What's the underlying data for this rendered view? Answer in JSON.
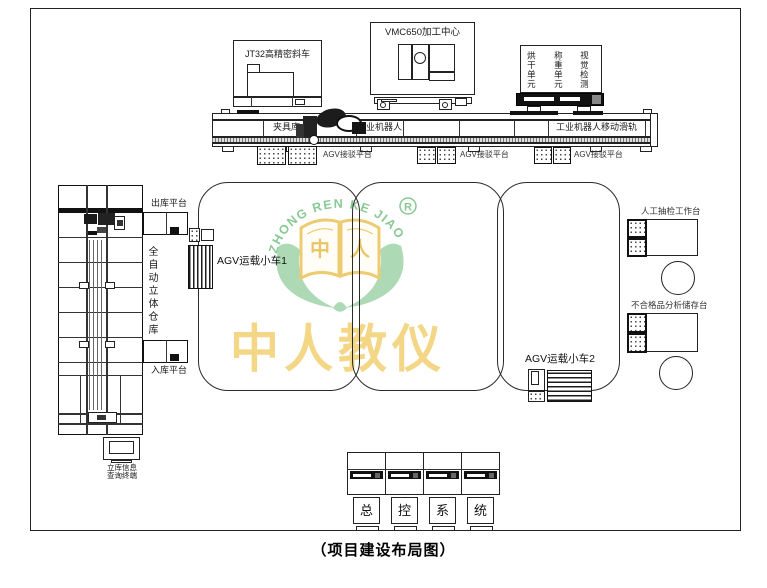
{
  "caption": "（项目建设布局图）",
  "machines": {
    "lathe_label": "JT32高精密斜车",
    "vmc_label": "VMC650加工中心",
    "unit_labels": [
      "烘干单元",
      "称重单元",
      "视觉检测"
    ]
  },
  "rail": {
    "fixture_store": "夹具库",
    "robot": "工业机器人",
    "robot_rail": "工业机器人移动滑轨",
    "agv_dock": "AGV接驳平台"
  },
  "warehouse": {
    "name_vertical": "全自动立体仓库",
    "outbound": "出库平台",
    "inbound": "入库平台",
    "terminal_line1": "立库信息",
    "terminal_line2": "查询终端"
  },
  "agv": {
    "cart1": "AGV运载小车1",
    "cart2": "AGV运载小车2"
  },
  "stations": {
    "manual_check": "人工抽检工作台",
    "defect_storage": "不合格品分析储存台"
  },
  "console": {
    "chars": [
      "总",
      "控",
      "系",
      "统"
    ]
  },
  "logo": {
    "arc_text": "ZHONG REN KE JIAO",
    "registered": "R",
    "book_left": "中",
    "book_right": "人",
    "watermark_text": "中人教仪"
  },
  "colors": {
    "logo_green": "#8fcf9a",
    "logo_gold": "#eac75e",
    "watermark_gold": "#f2d173",
    "line": "#222222"
  }
}
